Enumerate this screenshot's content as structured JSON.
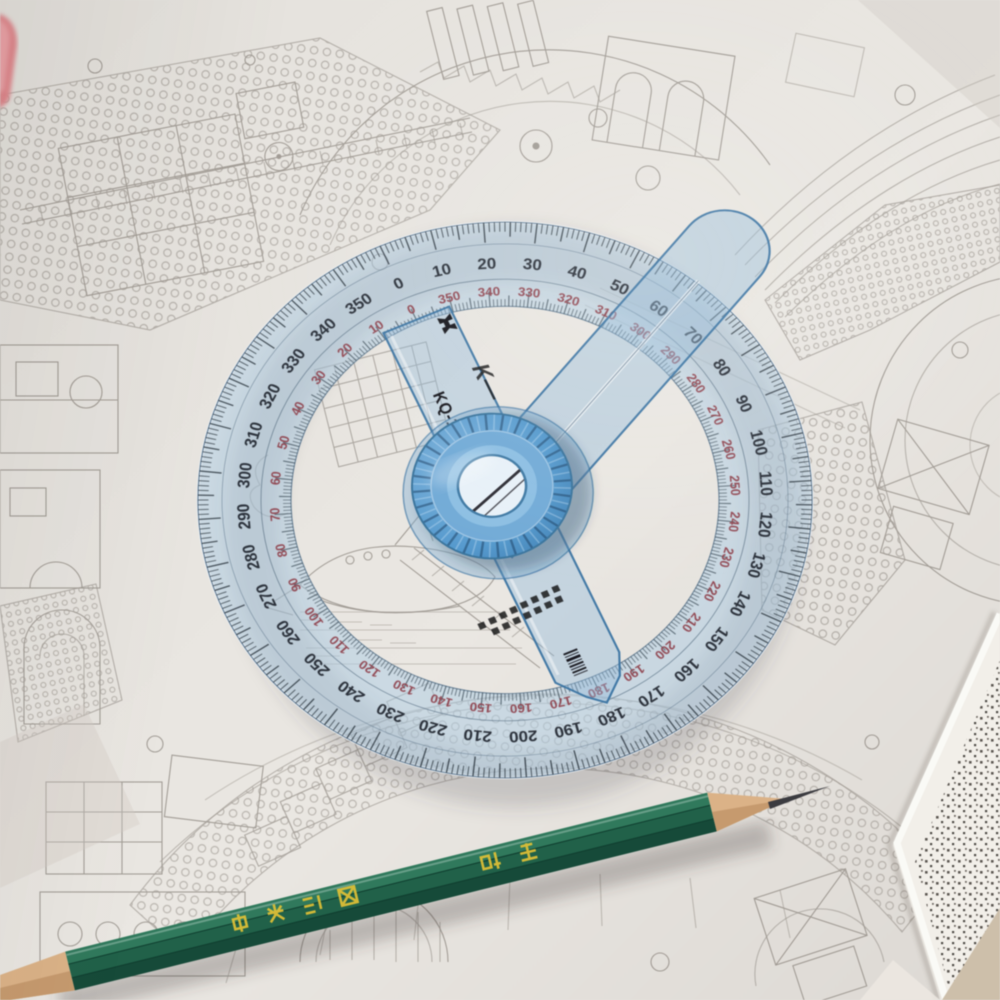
{
  "scene": {
    "alt_text": "Transparent blue 360-degree swing-arm protractor on a dense black-and-white architectural line drawing, green pencil sharpened at both visible ends across the bottom, pink object at top-left, page corner lifting at bottom-right."
  },
  "protractor": {
    "model_text": "KQ-100",
    "brand_script_text": "K—",
    "label_interval_degrees": 10,
    "tick_interval_degrees": 1,
    "outer_scale": {
      "direction": "clockwise",
      "unit": "degrees",
      "color": "#1d222b",
      "labels": [
        0,
        10,
        20,
        30,
        40,
        50,
        60,
        70,
        80,
        90,
        100,
        110,
        120,
        130,
        140,
        150,
        160,
        170,
        180,
        190,
        200,
        210,
        220,
        230,
        240,
        250,
        260,
        270,
        280,
        290,
        300,
        310,
        320,
        330,
        340,
        350
      ]
    },
    "inner_scale": {
      "direction": "counterclockwise",
      "unit": "degrees",
      "color": "#8e3c46",
      "labels": [
        0,
        10,
        20,
        30,
        40,
        50,
        60,
        70,
        80,
        90,
        100,
        110,
        120,
        130,
        140,
        150,
        160,
        170,
        180,
        190,
        200,
        210,
        220,
        230,
        240,
        250,
        260,
        270,
        280,
        290,
        300,
        310,
        320,
        330,
        340,
        350
      ]
    },
    "ring_fill": "#b0cee4",
    "arm_fill": "#8fbadb",
    "knob_fill": "#4f93cb"
  },
  "pencil": {
    "brand_text": "中华",
    "label_text": "绘图铅笔",
    "body_color": "#1f6149",
    "lettering_color": "#e3c133",
    "wood_color": "#dcb286",
    "graphite_color": "#3b3b40"
  },
  "paper": {
    "base_color": "#e7e4df",
    "ink_color": "#938d86",
    "undersheet_color": "#f2efe9",
    "desk_corner_color": "#cdbfa9",
    "pink_object_color": "#e2868c"
  }
}
